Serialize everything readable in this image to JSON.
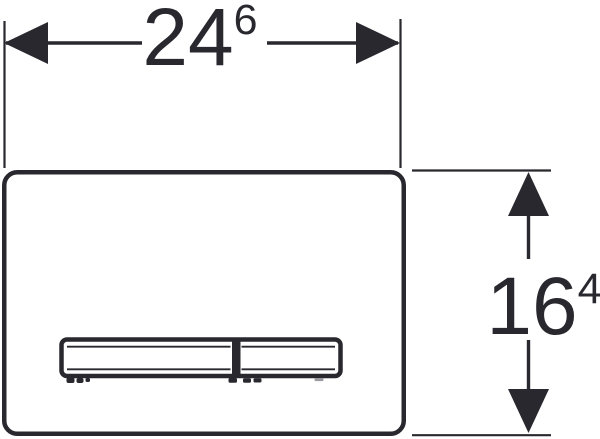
{
  "drawing": {
    "type": "technical-dimension-drawing",
    "subject": "rectangular flush plate with two-section actuator button",
    "width_dimension": {
      "value": "24",
      "superscript": "6"
    },
    "height_dimension": {
      "value": "16",
      "superscript": "4"
    },
    "colors": {
      "line": "#28282e",
      "background": "#ffffff",
      "faint_mark": "#9a9aa0"
    }
  }
}
